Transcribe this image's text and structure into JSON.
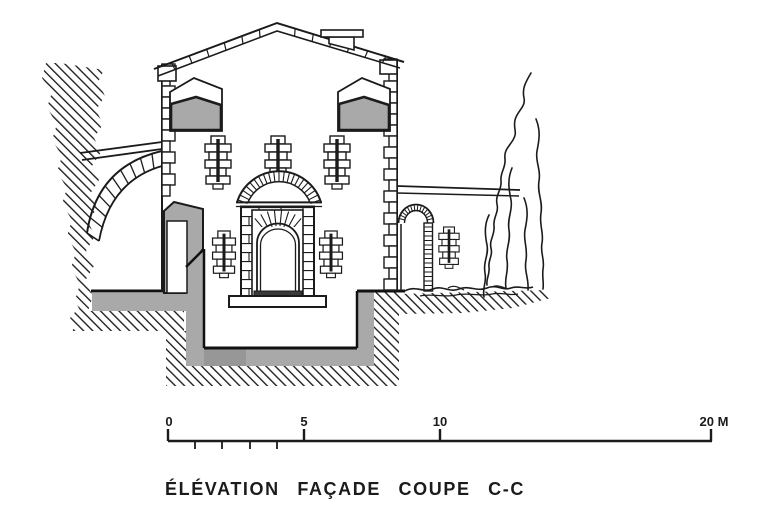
{
  "drawing": {
    "title": "ÉLÉVATION FAÇADE COUPE C-C",
    "scale_bar": {
      "unit": "M",
      "labels": {
        "l0": "0",
        "l5": "5",
        "l10": "10",
        "l20": "20 M"
      },
      "major_values": [
        0,
        5,
        10,
        20
      ],
      "minor_values": [
        1,
        2,
        3,
        4
      ]
    },
    "colors": {
      "ink": "#1b1b1b",
      "poche_gray": "#a9a9a9",
      "poche_dark": "#979797",
      "paper": "#ffffff"
    }
  }
}
